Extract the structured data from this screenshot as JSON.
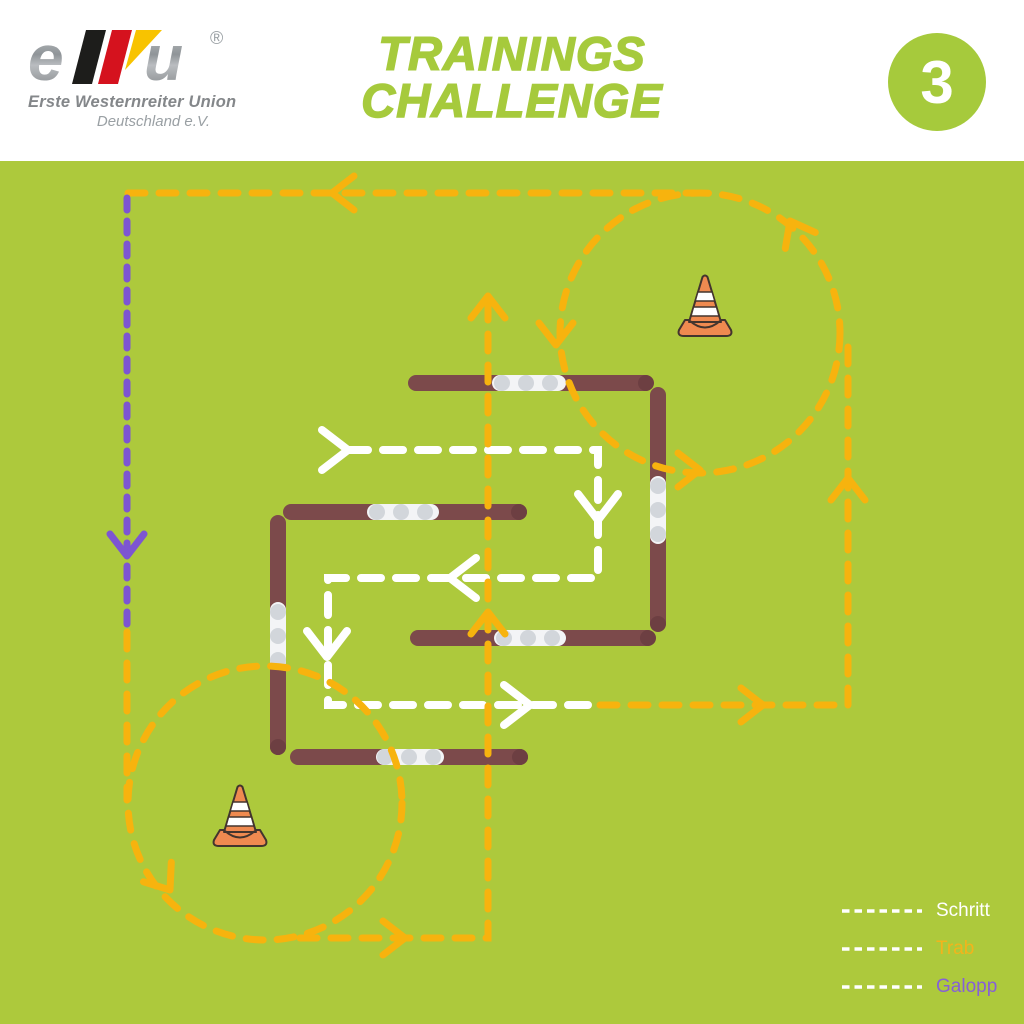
{
  "header": {
    "logo": {
      "letter_e": "e",
      "letter_u": "u",
      "registered": "®",
      "subtitle_line1": "Erste Westernreiter Union",
      "subtitle_line2": "Deutschland e.V."
    },
    "title": {
      "line1": "TRAININGS",
      "line2": "CHALLENGE"
    },
    "exercise_number": "3"
  },
  "legend": {
    "items": [
      {
        "label": "Schritt",
        "label_color": "#ffffff",
        "line_color": "#ffffff"
      },
      {
        "label": "Trab",
        "label_color": "#f2b41c",
        "line_color": "#ffffff"
      },
      {
        "label": "Galopp",
        "label_color": "#8660d6",
        "line_color": "#ffffff"
      }
    ]
  },
  "course": {
    "background_color": "#adc93c",
    "gait_line_colors": {
      "schritt": "#ffffff",
      "trab": "#f7b30e",
      "galopp": "#7d55d2"
    },
    "cone_count": 2,
    "ground_pole_groups": 2,
    "trot_circles": 2
  },
  "colors": {
    "accent_green": "#a6ca3c",
    "pole_brown": "#7c4a4b",
    "pole_stripe_gray": "#d2d6db",
    "cone_orange": "#ef8a50"
  }
}
